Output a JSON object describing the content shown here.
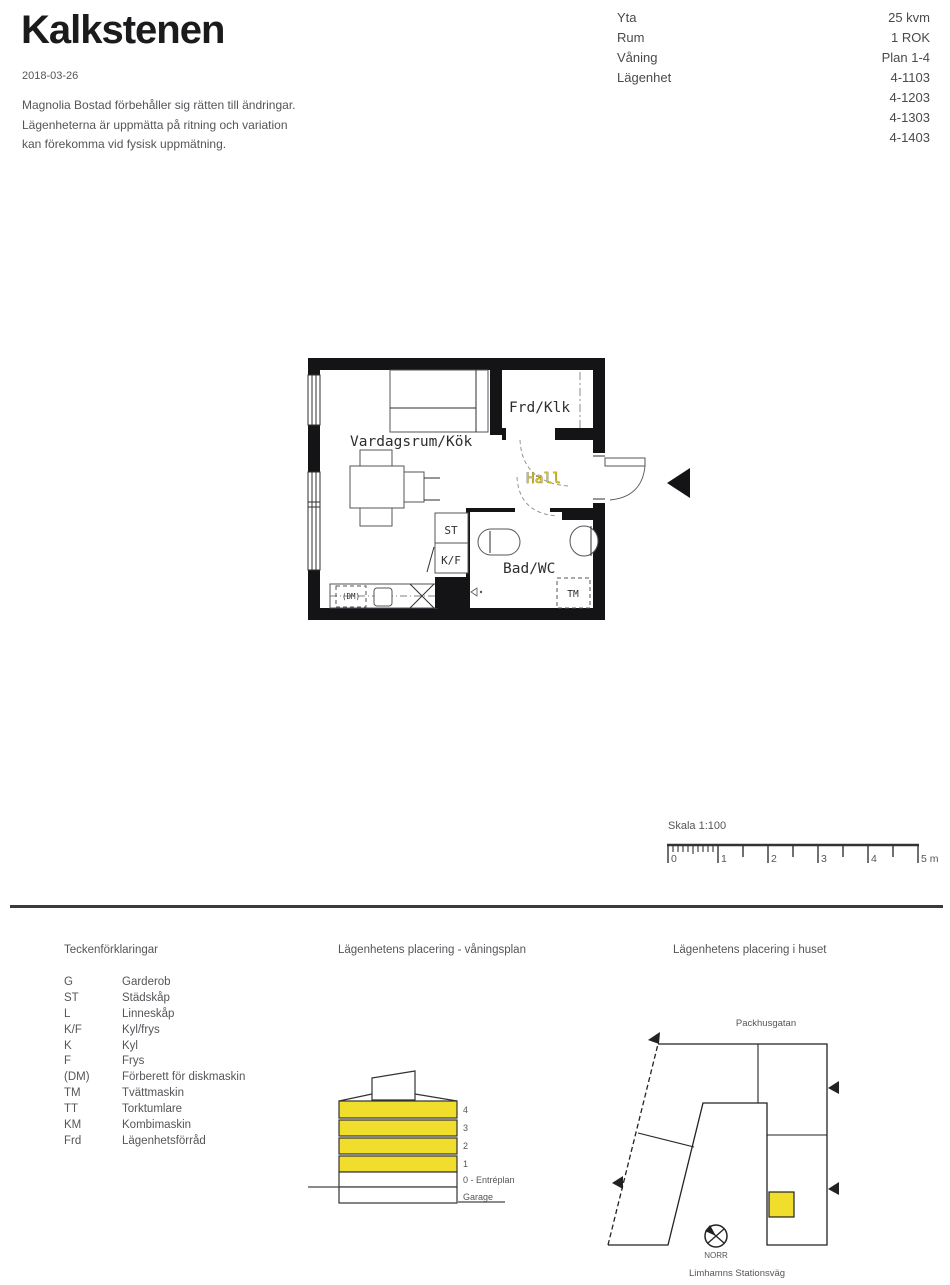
{
  "header": {
    "title": "Kalkstenen",
    "date": "2018-03-26",
    "disclaimer": [
      "Magnolia Bostad förbehåller sig rätten till ändringar.",
      "Lägenheterna är uppmätta på ritning och variation",
      "kan förekomma vid fysisk uppmätning."
    ]
  },
  "info": {
    "labels": [
      "Yta",
      "Rum",
      "Våning",
      "Lägenhet"
    ],
    "values": [
      "25 kvm",
      "1 ROK",
      "Plan 1-4",
      "4-1103",
      "4-1203",
      "4-1303",
      "4-1403"
    ]
  },
  "floor_plan": {
    "room_labels": {
      "living": "Vardagsrum/Kök",
      "storage": "Frd/Klk",
      "hall": "Hall",
      "bath": "Bad/WC"
    },
    "fixture_labels": {
      "st": "ST",
      "kf": "K/F",
      "dm": "(DM)",
      "tm": "TM"
    }
  },
  "scale_bar": {
    "title": "Skala 1:100",
    "tick_labels": [
      "0",
      "1",
      "2",
      "3",
      "4",
      "5 m"
    ]
  },
  "legend": {
    "heading": "Teckenförklaringar",
    "items": [
      {
        "abbr": "G",
        "desc": "Garderob"
      },
      {
        "abbr": "ST",
        "desc": "Städskåp"
      },
      {
        "abbr": "L",
        "desc": "Linneskåp"
      },
      {
        "abbr": "K/F",
        "desc": "Kyl/frys"
      },
      {
        "abbr": "K",
        "desc": "Kyl"
      },
      {
        "abbr": "F",
        "desc": "Frys"
      },
      {
        "abbr": "(DM)",
        "desc": "Förberett för diskmaskin"
      },
      {
        "abbr": "TM",
        "desc": "Tvättmaskin"
      },
      {
        "abbr": "TT",
        "desc": "Torktumlare"
      },
      {
        "abbr": "KM",
        "desc": "Kombimaskin"
      },
      {
        "abbr": "Frd",
        "desc": "Lägenhetsförråd"
      }
    ]
  },
  "elevation": {
    "heading": "Lägenhetens placering - våningsplan",
    "floor_labels": [
      "4",
      "3",
      "2",
      "1",
      "0 - Entréplan",
      "Garage"
    ],
    "highlight_color": "#f1dd2b"
  },
  "site_plan": {
    "heading": "Lägenhetens placering i huset",
    "street_top": "Packhusgatan",
    "street_bottom": "Limhamns Stationsväg",
    "compass_label": "NORR",
    "marker_color": "#f1dd2b"
  }
}
